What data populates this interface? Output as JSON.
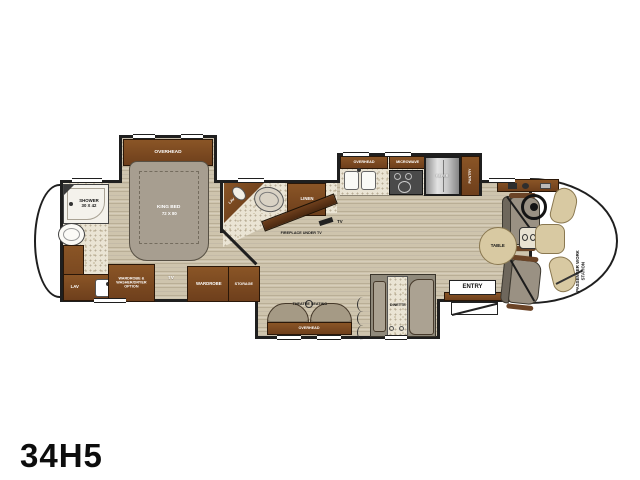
{
  "model": "34H5",
  "colors": {
    "wall": "#1f1f1f",
    "cabinet": "#7a4a26",
    "cabinet-dark": "#4a2810",
    "floor": "#cec4ad",
    "tile": "#eae4d4",
    "bed": "#a79e90",
    "seat": "#9a9183",
    "tan": "#d8c9a2",
    "steel": "#bcbcbc",
    "text-light": "#ffffff",
    "text-dark": "#161616"
  },
  "labels": {
    "bedroom": {
      "overhead": "OVERHEAD",
      "bed_line1": "KING BED",
      "bed_line2": "72 X 80",
      "wardrobe_washer": "WARDROBE & WASHER/DRYER OPTION",
      "tv": "TV",
      "wardrobe": "WARDROBE",
      "storage": "STORAGE"
    },
    "rear_bath": {
      "shower_line1": "SHOWER",
      "shower_line2": "30 X 42",
      "lav": "LAV"
    },
    "mid_bath": {
      "lav": "LAV",
      "linen": "LINEN"
    },
    "living": {
      "fireplace": "FIREPLACE UNDER TV",
      "tv": "TV",
      "theatre": "THEATRE SEATING",
      "overhead": "OVERHEAD",
      "dinette": "DINETTE"
    },
    "kitchen": {
      "overhead": "OVERHEAD",
      "microwave": "MICROWAVE",
      "refer": "REFER",
      "pantry": "PANTRY"
    },
    "cab": {
      "table": "TABLE",
      "entry": "ENTRY",
      "work_station": "PASSENGER WORK STATION"
    }
  },
  "icons": {
    "toilet": "ellipse-fixture",
    "shower_head": "dot",
    "sink": "rounded-basin",
    "cooktop": "burner-rings",
    "steering_wheel": "ring",
    "laptop": "open-laptop-glyph",
    "cupholder": "small-circle",
    "accordion_door": "arc"
  }
}
